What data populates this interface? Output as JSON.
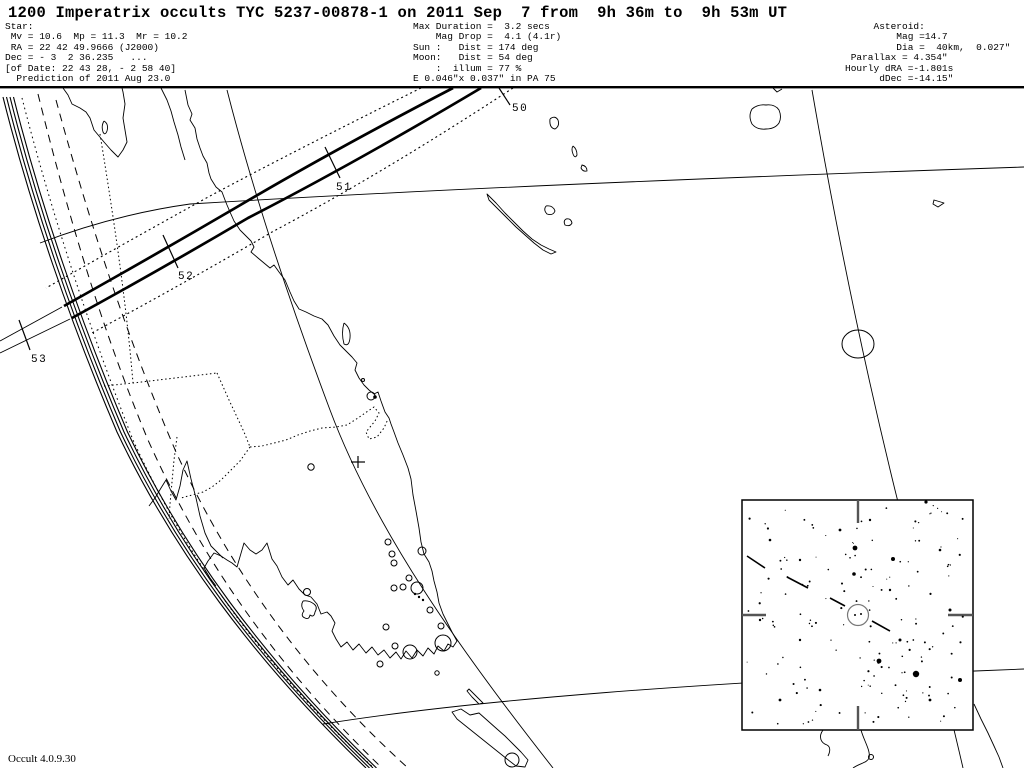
{
  "header": {
    "title": "1200 Imperatrix occults TYC 5237-00878-1 on 2011 Sep  7 from  9h 36m to  9h 53m UT",
    "star_block": "Star:\n Mv = 10.6  Mp = 11.3  Mr = 10.2\n RA = 22 42 49.9666 (J2000)\nDec = - 3  2 36.235   ...\n[of Date: 22 43 28, - 2 58 40]\n  Prediction of 2011 Aug 23.0",
    "event_block": "Max Duration =  3.2 secs\n    Mag Drop =  4.1 (4.1r)\nSun :   Dist = 174 deg\nMoon:   Dist = 54 deg\n    :  illum = 77 %\nE 0.046\"x 0.037\" in PA 75",
    "asteroid_block": "     Asteroid:\n         Mag =14.7\n         Dia =  40km,  0.027\"\n Parallax = 4.354\"\nHourly dRA =-1.801s\n      dDec =-14.15\""
  },
  "footer": {
    "version_label": "Occult 4.0.9.30"
  },
  "map": {
    "top_border": {
      "x": 0,
      "y": 86,
      "w": 1024,
      "h": 2.4
    },
    "grid": [
      "M40,243 C90,224 140,211 190,204 C420,190 700,178 1024,167",
      "M323,724 C480,699 700,683 975,671 L1024,669",
      "M227,90 C250,180 285,290 330,410 C375,530 460,650 553,768",
      "M812,90 C838,240 868,380 895,490 C920,590 945,690 963,768"
    ],
    "limb": {
      "d": "M3,97 C30,205 70,322 117,432 C172,548 252,658 366,768",
      "offsets": [
        0,
        3.5,
        7,
        10.5
      ]
    },
    "aux_dashed": [
      "M38,94 C68,215 102,330 148,440 C200,556 272,662 382,768",
      "M56,100 C90,225 128,340 176,452 C230,570 306,676 408,768"
    ],
    "aux_dotted": [
      "M22,98 C52,215 90,330 133,440 C186,556 260,664 374,768"
    ],
    "occ_path": {
      "thick": [
        "M453,88 Q330,152 237,207 Q148,259 64,306",
        "M481,88 Q355,163 248,218 Q158,271 72,318"
      ],
      "dotted": [
        "M421,88 Q300,148 210,196 Q125,243 46,288",
        "M513,88 Q385,172 272,232 Q185,283 90,334"
      ],
      "extensions": [
        "M0,341 L62,307",
        "M0,353 L70,319"
      ]
    },
    "path_ticks": [
      {
        "label": "50",
        "lx": 512,
        "ly": 111,
        "x1": 499,
        "y1": 88,
        "x2": 510,
        "y2": 105
      },
      {
        "label": "51",
        "lx": 336,
        "ly": 190,
        "x1": 325,
        "y1": 147,
        "x2": 340,
        "y2": 178
      },
      {
        "label": "52",
        "lx": 178,
        "ly": 279,
        "x1": 163,
        "y1": 235,
        "x2": 178,
        "y2": 268
      },
      {
        "label": "53",
        "lx": 31,
        "ly": 362,
        "x1": 19,
        "y1": 320,
        "x2": 30,
        "y2": 350
      }
    ],
    "coastlines": [
      "M63,88 L68,95 L72,104 L80,108 L86,112 L90,118 L94,130 L99,136 L104,142 L111,150 L118,157 L123,150 L127,142 L125,130 L123,118 L125,104 L123,92 L122,88",
      "M104,121 Q109,124 107,131 Q105,136 103,132 Q101,126 104,121",
      "M161,88 L167,100 L171,111 L174,122 L178,135 L181,147 L185,160",
      "M185,90 L188,105 L192,114 L190,120 L195,128 L197,139 L200,148 L203,156 L207,163 L209,173 L211,179 L216,187 L222,192 L225,200 L227,205 L230,212 L234,221 L240,230 L246,236 L251,241 L254,247 L251,252 L258,258 L264,263 L270,268 L274,265 L279,272 L285,280 L290,292 L294,301 L299,309 L306,312 L314,316 L322,319 L328,325 L334,336 L340,345 L347,352 L352,357 L357,363 L355,370 L359,378 L364,385 L369,390 L374,394 L378,392 L381,401 L385,412 L389,418 L391,424 L394,432 L398,443 L403,455 L408,468 L411,479 L413,495 L416,511 L419,528 L421,542 L424,554 L429,562 L432,571 L434,581 L437,592 L439,603 L443,614 L448,624 L452,632 L457,641 L453,647 L448,644 L444,651 L438,646 L434,654 L428,648 L423,656 L417,650 L412,658 L406,651 L401,659 L396,652 L390,658 L384,650 L378,655 L372,647 L366,653 L359,644 L353,650 L347,642 L341,647 L336,639 L332,631 L335,623 L331,616 L327,612 L321,614 L317,604 L311,597 L305,595 L299,589 L293,580 L288,585 L282,577 L277,566 L272,559 L267,543 L262,550 L256,554 L250,550 L244,543 L237,567 L232,563 L227,560 L221,556 L214,553 L208,561 L204,568 L210,578 L216,586",
      "M149,506 L155,498 L161,488 L166,480 L171,491 L176,500 L180,486 L183,470 L187,461 L191,479 L196,498 L200,516 L205,533 L211,546 L217,552 L223,558",
      "M344,323 Q351,328 350,338 Q349,347 344,344 Q341,333 344,323",
      "M303,601 Q300,606 304,611 Q300,616 305,618 Q309,620 310,615 Q314,618 315,612 Q318,607 314,604 Q309,600 303,601",
      "M469,689 L476,696 L483,703 L479,704 L472,697 L467,691 Z",
      "M452,712 L461,709 L470,715 L479,713 L488,721 L497,729 L505,736 L513,744 L521,752 L528,760 L525,767 L516,766 L507,759 L497,751 L487,743 L477,735 L467,727 L457,719 Z",
      "M487,194 L496,203 L505,213 L514,222 L523,231 L532,239 L541,245 L549,249 L556,252 L551,254 L543,250 L534,243 L525,235 L516,227 L507,218 L497,208 L489,200 Z",
      "M546,206 Q553,205 555,211 Q553,216 547,214 Q543,210 546,206",
      "M566,219 Q571,218 572,223 Q570,227 565,225 Q563,221 566,219",
      "M550,119 Q555,115 558,120 Q560,126 555,129 Q549,128 550,119",
      "M573,146 Q577,149 577,155 Q575,159 573,154 Q571,149 573,146",
      "M582,165 Q587,166 587,171 Q583,172 581,168 Z",
      "M752,109 Q758,104 766,105 Q775,104 779,110 Q782,117 779,123 Q775,129 766,129 Q757,130 752,124 Q748,116 752,109",
      "M934,200 L944,203 L938,207 L933,204 Z",
      "M773,88 L777,92 L782,89",
      "M823,730 C818,737 821,743 827,745 C831,747 830,752 828,756",
      "M861,730 C864,741 871,751 869,758 C867,763 860,763 853,768",
      "M974,704 L981,719 L988,733 L994,746 L999,757 L1003,768"
    ],
    "borders": [
      "M100,134 C114,220 126,300 133,383",
      "M104,386 L133,383 L217,373",
      "M217,373 L229,400 L237,417 L244,432 L250,447",
      "M250,447 L240,461 L231,470 L221,480 L212,487 L203,492 L192,495 L181,498",
      "M177,437 L174,460 L172,482 L170,504 L169,519",
      "M250,447 L262,446 L274,443 L286,440 L298,435 L310,431 L322,428 L336,427 L347,425 L358,418 L368,411 L374,407 L379,413 L375,421 L366,432 L369,439 L377,437 L384,428 L388,419"
    ],
    "markers": {
      "circles": [
        {
          "cx": 371,
          "cy": 396,
          "r": 4
        },
        {
          "cx": 422,
          "cy": 551,
          "r": 4
        },
        {
          "cx": 311,
          "cy": 467,
          "r": 3.2
        },
        {
          "cx": 363,
          "cy": 380,
          "r": 1.5
        },
        {
          "cx": 388,
          "cy": 542,
          "r": 3
        },
        {
          "cx": 392,
          "cy": 554,
          "r": 3
        },
        {
          "cx": 394,
          "cy": 563,
          "r": 3
        },
        {
          "cx": 403,
          "cy": 587,
          "r": 3
        },
        {
          "cx": 394,
          "cy": 588,
          "r": 3
        },
        {
          "cx": 409,
          "cy": 578,
          "r": 3
        },
        {
          "cx": 417,
          "cy": 588,
          "r": 6
        },
        {
          "cx": 430,
          "cy": 610,
          "r": 3
        },
        {
          "cx": 441,
          "cy": 626,
          "r": 3
        },
        {
          "cx": 386,
          "cy": 627,
          "r": 3
        },
        {
          "cx": 395,
          "cy": 646,
          "r": 3
        },
        {
          "cx": 380,
          "cy": 664,
          "r": 3
        },
        {
          "cx": 437,
          "cy": 673,
          "r": 2.2
        },
        {
          "cx": 307,
          "cy": 592,
          "r": 3.5
        },
        {
          "cx": 410,
          "cy": 652,
          "r": 7
        },
        {
          "cx": 443,
          "cy": 643,
          "r": 8
        },
        {
          "cx": 512,
          "cy": 760,
          "r": 7
        },
        {
          "cx": 871,
          "cy": 757,
          "r": 2.5
        }
      ],
      "dots": [
        {
          "cx": 375,
          "cy": 397,
          "r": 1.8
        },
        {
          "cx": 415,
          "cy": 594,
          "r": 1.2
        },
        {
          "cx": 419,
          "cy": 597,
          "r": 1.2
        },
        {
          "cx": 423,
          "cy": 600,
          "r": 1.2
        }
      ],
      "ellipse": {
        "cx": 858,
        "cy": 344,
        "rx": 16,
        "ry": 14
      },
      "plus": {
        "cx": 358,
        "cy": 462,
        "arm": 7
      }
    },
    "inset": {
      "box": {
        "x": 742,
        "y": 500,
        "w": 231,
        "h": 230
      },
      "ticks": [
        [
          858,
          500,
          858,
          523
        ],
        [
          858,
          706,
          858,
          730
        ],
        [
          742,
          615,
          766,
          615
        ],
        [
          948,
          615,
          973,
          615
        ]
      ],
      "target_circle": {
        "cx": 858,
        "cy": 615,
        "r": 10.5
      },
      "target_dots": [
        {
          "cx": 855,
          "cy": 615,
          "r": 1
        },
        {
          "cx": 861,
          "cy": 614,
          "r": 1
        }
      ],
      "track_dashes": [
        [
          747,
          556,
          765,
          568
        ],
        [
          787,
          577,
          808,
          588
        ],
        [
          830,
          598,
          845,
          606
        ],
        [
          872,
          621,
          890,
          631
        ]
      ],
      "stars_notable": [
        {
          "cx": 855,
          "cy": 548,
          "r": 2.4
        },
        {
          "cx": 893,
          "cy": 559,
          "r": 2.0
        },
        {
          "cx": 854,
          "cy": 574,
          "r": 1.8
        },
        {
          "cx": 879,
          "cy": 661,
          "r": 2.4
        },
        {
          "cx": 916,
          "cy": 674,
          "r": 3.2
        },
        {
          "cx": 960,
          "cy": 680,
          "r": 2.0
        },
        {
          "cx": 926,
          "cy": 502,
          "r": 1.6
        },
        {
          "cx": 840,
          "cy": 530,
          "r": 1.4
        },
        {
          "cx": 800,
          "cy": 560,
          "r": 1.2
        },
        {
          "cx": 770,
          "cy": 540,
          "r": 1.3
        },
        {
          "cx": 900,
          "cy": 640,
          "r": 1.5
        },
        {
          "cx": 930,
          "cy": 700,
          "r": 1.4
        },
        {
          "cx": 820,
          "cy": 690,
          "r": 1.3
        },
        {
          "cx": 760,
          "cy": 620,
          "r": 1.2
        },
        {
          "cx": 890,
          "cy": 590,
          "r": 1.2
        },
        {
          "cx": 940,
          "cy": 550,
          "r": 1.3
        },
        {
          "cx": 800,
          "cy": 640,
          "r": 1.2
        },
        {
          "cx": 780,
          "cy": 700,
          "r": 1.4
        },
        {
          "cx": 950,
          "cy": 610,
          "r": 1.5
        },
        {
          "cx": 870,
          "cy": 520,
          "r": 1.2
        }
      ],
      "scatter": {
        "seed": 7,
        "count": 155,
        "r_min": 0.5,
        "r_max": 1.1
      }
    }
  }
}
